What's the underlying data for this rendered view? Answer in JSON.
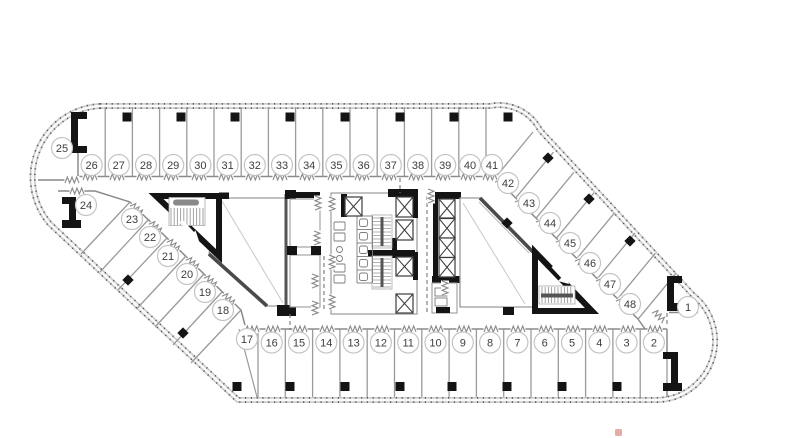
{
  "diagram": {
    "type": "architectural-floor-plan",
    "description": "Typical office tower floor plan, elongated hexagonal slab with rounded ends, 48 perimeter units around two service cores with elevators, stairs and restrooms"
  },
  "colors": {
    "background": "#ffffff",
    "heavy_wall": "#141414",
    "line": "#8a8a8a",
    "light_line": "#bfbfbf",
    "label_text": "#3d3d3d",
    "watermark_red": "#c84a3c"
  },
  "units": [
    {
      "n": "1",
      "x": 688,
      "y": 307,
      "door": [
        659,
        316,
        46
      ]
    },
    {
      "n": "2",
      "x": 653.9,
      "y": 342.5,
      "door": [
        655,
        329,
        0
      ]
    },
    {
      "n": "3",
      "x": 626.6,
      "y": 342.5,
      "door": [
        628,
        329,
        0
      ]
    },
    {
      "n": "4",
      "x": 599.3,
      "y": 342.5,
      "door": [
        600,
        329,
        0
      ]
    },
    {
      "n": "5",
      "x": 572,
      "y": 342.5,
      "door": [
        573,
        329,
        0
      ]
    },
    {
      "n": "6",
      "x": 544.7,
      "y": 342.5,
      "door": [
        546,
        329,
        0
      ]
    },
    {
      "n": "7",
      "x": 517.4,
      "y": 342.5,
      "door": [
        518,
        329,
        0
      ]
    },
    {
      "n": "8",
      "x": 490.1,
      "y": 342.5,
      "door": [
        491,
        329,
        0
      ]
    },
    {
      "n": "9",
      "x": 462.8,
      "y": 342.5,
      "door": [
        464,
        329,
        0
      ]
    },
    {
      "n": "10",
      "x": 435.5,
      "y": 342.5,
      "door": [
        436,
        329,
        0
      ]
    },
    {
      "n": "11",
      "x": 408.2,
      "y": 342.5,
      "door": [
        409,
        329,
        0
      ]
    },
    {
      "n": "12",
      "x": 380.9,
      "y": 342.5,
      "door": [
        382,
        329,
        0
      ]
    },
    {
      "n": "13",
      "x": 353.6,
      "y": 342.5,
      "door": [
        355,
        329,
        0
      ]
    },
    {
      "n": "14",
      "x": 326.3,
      "y": 342.5,
      "door": [
        327,
        329,
        0
      ]
    },
    {
      "n": "15",
      "x": 299,
      "y": 342.5,
      "door": [
        300,
        329,
        0
      ]
    },
    {
      "n": "16",
      "x": 271.7,
      "y": 342.5,
      "door": [
        273,
        329,
        0
      ]
    },
    {
      "n": "17",
      "x": 247,
      "y": 339,
      "door": [
        252,
        329,
        0
      ]
    },
    {
      "n": "18",
      "x": 223,
      "y": 310,
      "door": [
        229,
        299,
        44
      ]
    },
    {
      "n": "19",
      "x": 205,
      "y": 292,
      "door": [
        211,
        281,
        44
      ]
    },
    {
      "n": "20",
      "x": 187,
      "y": 274,
      "door": [
        193,
        263,
        44
      ]
    },
    {
      "n": "21",
      "x": 168,
      "y": 256,
      "door": [
        174,
        245,
        44
      ]
    },
    {
      "n": "22",
      "x": 150,
      "y": 237,
      "door": [
        156,
        227,
        44
      ]
    },
    {
      "n": "23",
      "x": 132,
      "y": 219,
      "door": [
        137,
        209,
        44
      ]
    },
    {
      "n": "24",
      "x": 86,
      "y": 205,
      "door": [
        77,
        191,
        0
      ]
    },
    {
      "n": "25",
      "x": 62,
      "y": 148,
      "door": [
        72,
        180,
        0
      ]
    },
    {
      "n": "26",
      "x": 91.6,
      "y": 165,
      "door": [
        90,
        177,
        0
      ]
    },
    {
      "n": "27",
      "x": 118.8,
      "y": 165,
      "door": [
        117,
        177,
        0
      ]
    },
    {
      "n": "28",
      "x": 146,
      "y": 165,
      "door": [
        144,
        177,
        0
      ]
    },
    {
      "n": "29",
      "x": 173.2,
      "y": 165,
      "door": [
        171,
        177,
        0
      ]
    },
    {
      "n": "30",
      "x": 200.4,
      "y": 165,
      "door": [
        199,
        177,
        0
      ]
    },
    {
      "n": "31",
      "x": 227.6,
      "y": 165,
      "door": [
        226,
        177,
        0
      ]
    },
    {
      "n": "32",
      "x": 254.8,
      "y": 165,
      "door": [
        253,
        177,
        0
      ]
    },
    {
      "n": "33",
      "x": 282,
      "y": 165,
      "door": [
        280,
        177,
        0
      ]
    },
    {
      "n": "34",
      "x": 309.2,
      "y": 165,
      "door": [
        307,
        177,
        0
      ]
    },
    {
      "n": "35",
      "x": 336.4,
      "y": 165,
      "door": [
        335,
        177,
        0
      ]
    },
    {
      "n": "36",
      "x": 363.6,
      "y": 165,
      "door": [
        362,
        177,
        0
      ]
    },
    {
      "n": "37",
      "x": 390.8,
      "y": 165,
      "door": [
        389,
        177,
        0
      ]
    },
    {
      "n": "38",
      "x": 418,
      "y": 165,
      "door": [
        416,
        177,
        0
      ]
    },
    {
      "n": "39",
      "x": 445.2,
      "y": 165,
      "door": [
        443,
        177,
        0
      ]
    },
    {
      "n": "40",
      "x": 470,
      "y": 165,
      "door": [
        468,
        177,
        0
      ]
    },
    {
      "n": "41",
      "x": 492,
      "y": 165,
      "door": [
        490,
        177,
        0
      ]
    },
    {
      "n": "42",
      "x": 508,
      "y": 183,
      "door": [
        502,
        185,
        45
      ]
    },
    {
      "n": "43",
      "x": 529,
      "y": 203,
      "door": [
        522,
        205,
        45
      ]
    },
    {
      "n": "44",
      "x": 550,
      "y": 223,
      "door": [
        543,
        225,
        45
      ]
    },
    {
      "n": "45",
      "x": 570,
      "y": 243,
      "door": [
        563,
        245,
        45
      ]
    },
    {
      "n": "46",
      "x": 590,
      "y": 263,
      "door": [
        582,
        264,
        45
      ]
    },
    {
      "n": "47",
      "x": 610,
      "y": 284,
      "door": [
        603,
        284,
        45
      ]
    },
    {
      "n": "48",
      "x": 630,
      "y": 304,
      "door": [
        623,
        304,
        45
      ]
    }
  ],
  "geometry": {
    "top_band": {
      "wall_y1": 107,
      "wall_y2": 176.5,
      "dividers_x": [
        105.2,
        132.4,
        159.6,
        186.8,
        214,
        241.2,
        268.4,
        295.6,
        322.8,
        350,
        377.2,
        404.4,
        431.6,
        458.8,
        486
      ]
    },
    "bottom_band": {
      "wall_y1": 329,
      "wall_y2": 397,
      "dividers_x": [
        258,
        285.3,
        312.6,
        339.9,
        367.2,
        394.5,
        421.8,
        449.1,
        476.4,
        503.7,
        531,
        558.3,
        585.6,
        612.9,
        640.2,
        667
      ]
    },
    "left_band_dividers": [
      [
        81,
        254,
        130,
        202
      ],
      [
        100,
        272,
        149,
        219
      ],
      [
        118,
        290,
        167,
        238
      ],
      [
        136.5,
        309,
        186,
        256
      ],
      [
        155,
        327,
        204,
        274
      ],
      [
        173,
        345,
        222,
        292
      ],
      [
        191,
        363,
        241,
        310
      ]
    ],
    "right_band_dividers": [
      [
        533,
        132,
        495,
        178
      ],
      [
        553.4,
        152.2,
        515.4,
        198.2
      ],
      [
        573.8,
        172.4,
        535.8,
        218.4
      ],
      [
        594.2,
        192.6,
        556.2,
        238.6
      ],
      [
        614.6,
        212.8,
        576.6,
        258.8
      ],
      [
        635,
        233,
        597,
        279
      ],
      [
        655.4,
        253.2,
        617.4,
        299.2
      ],
      [
        675.8,
        273.4,
        637.8,
        319.4
      ]
    ],
    "slant_divider_17_16": [
      239,
      329,
      257,
      397
    ],
    "columns_top": {
      "y": 117,
      "xs": [
        127,
        181,
        235,
        290,
        345,
        400,
        454,
        508
      ]
    },
    "columns_bottom": {
      "y": 386.5,
      "xs": [
        237,
        290,
        345,
        400,
        452,
        507,
        562,
        617
      ]
    },
    "diamond_columns": [
      [
        128,
        280
      ],
      [
        183,
        333
      ],
      [
        548,
        158
      ],
      [
        589,
        199
      ],
      [
        630,
        241
      ],
      [
        507,
        223
      ]
    ],
    "elevator_boxes": [
      [
        396,
        197,
        17,
        20
      ],
      [
        396,
        220,
        17,
        20
      ],
      [
        396,
        257,
        17,
        19
      ],
      [
        396,
        294,
        17,
        19
      ],
      [
        345,
        197,
        17,
        19
      ],
      [
        439,
        199,
        16,
        19
      ],
      [
        439,
        218.5,
        16,
        19.5
      ],
      [
        439,
        238,
        16,
        19.5
      ],
      [
        439,
        257.5,
        16,
        19.5
      ]
    ],
    "extra_doors": [
      [
        332,
        204,
        90
      ],
      [
        332,
        262,
        90
      ],
      [
        332,
        302,
        90
      ],
      [
        318,
        203,
        90
      ],
      [
        317,
        238,
        90
      ],
      [
        315,
        281,
        90
      ],
      [
        315,
        308,
        90
      ],
      [
        431,
        196,
        90
      ],
      [
        445,
        288,
        90
      ]
    ]
  }
}
